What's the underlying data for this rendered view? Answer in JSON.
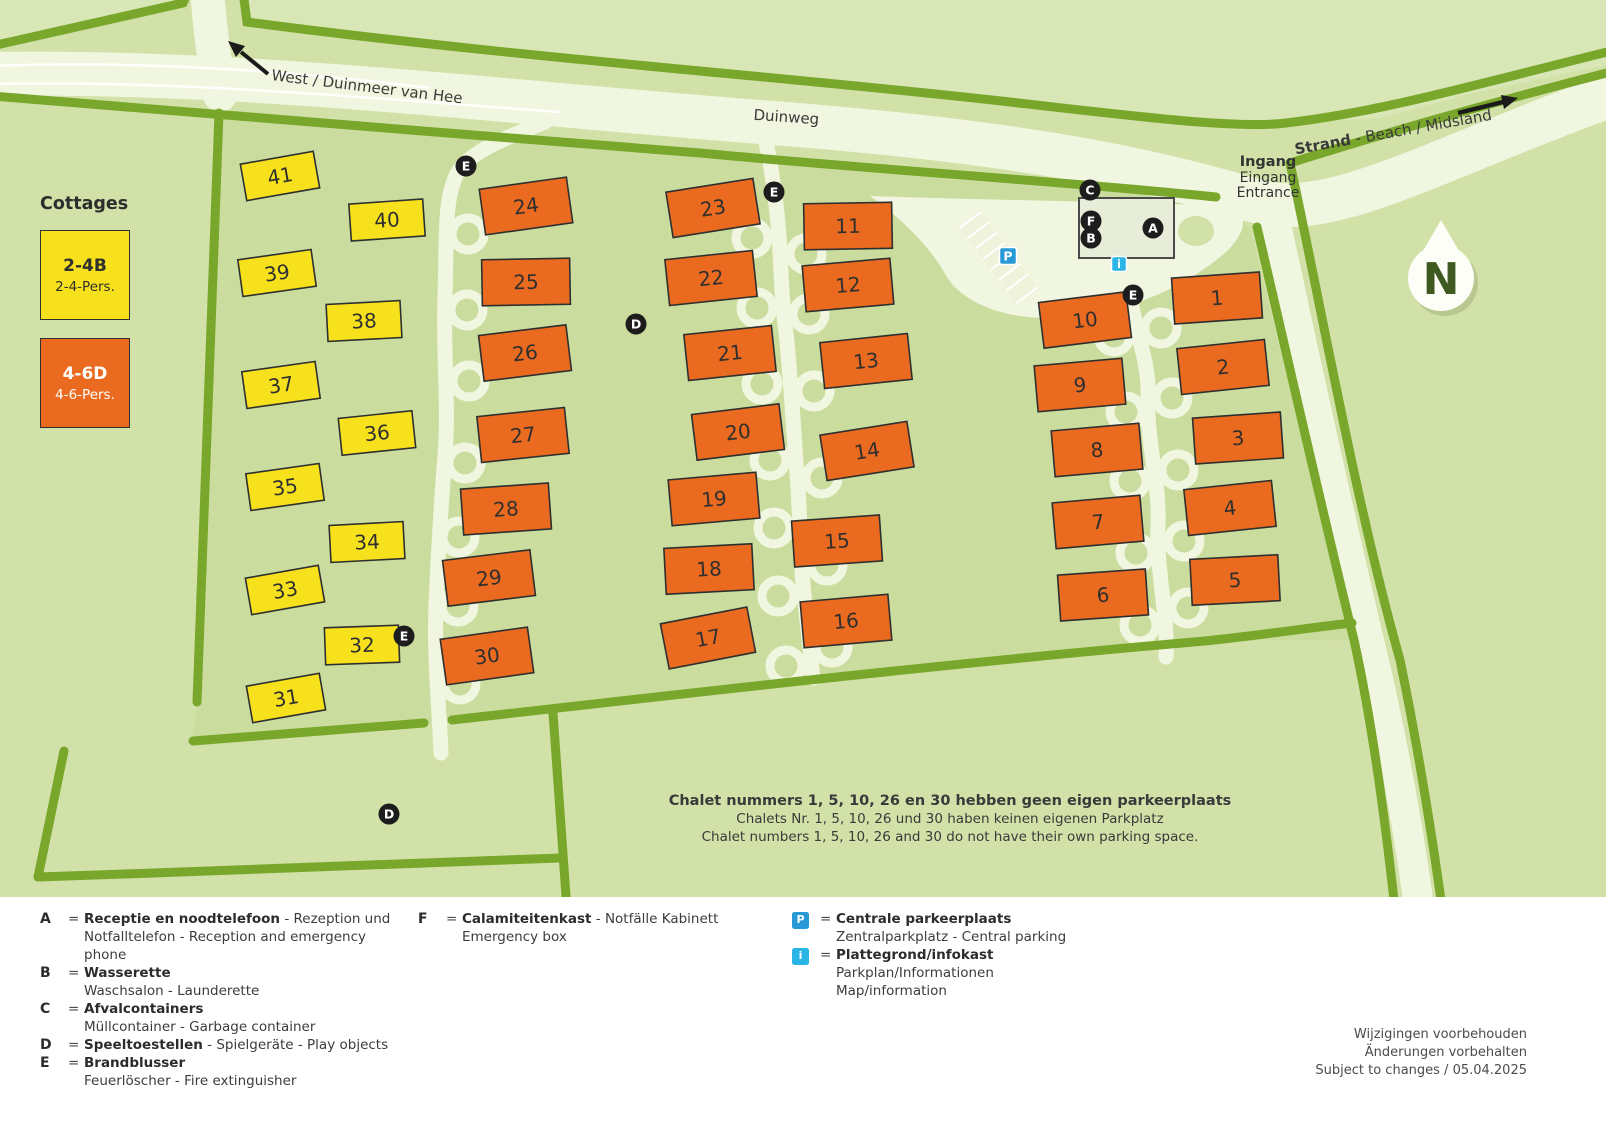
{
  "map": {
    "labels": {
      "west": "West / Duinmeer van Hee",
      "duinweg": "Duinweg",
      "strand_bold": "Strand",
      "strand_rest": " - Beach / Midsland",
      "ingang": [
        "Ingang",
        "Eingang",
        "Entrance"
      ],
      "compass": "N"
    },
    "chalets": [
      {
        "n": "41",
        "x": 280,
        "y": 176,
        "r": -10,
        "t": "y"
      },
      {
        "n": "40",
        "x": 387,
        "y": 220,
        "r": -4,
        "t": "y"
      },
      {
        "n": "39",
        "x": 277,
        "y": 273,
        "r": -8,
        "t": "y"
      },
      {
        "n": "38",
        "x": 364,
        "y": 321,
        "r": -3,
        "t": "y"
      },
      {
        "n": "37",
        "x": 281,
        "y": 385,
        "r": -8,
        "t": "y"
      },
      {
        "n": "36",
        "x": 377,
        "y": 433,
        "r": -6,
        "t": "y"
      },
      {
        "n": "35",
        "x": 285,
        "y": 487,
        "r": -8,
        "t": "y"
      },
      {
        "n": "34",
        "x": 367,
        "y": 542,
        "r": -3,
        "t": "y"
      },
      {
        "n": "33",
        "x": 285,
        "y": 590,
        "r": -10,
        "t": "y"
      },
      {
        "n": "32",
        "x": 362,
        "y": 645,
        "r": -2,
        "t": "y"
      },
      {
        "n": "31",
        "x": 286,
        "y": 698,
        "r": -10,
        "t": "y"
      },
      {
        "n": "24",
        "x": 526,
        "y": 206,
        "r": -8,
        "t": "o",
        "lx": 468,
        "ly": 234
      },
      {
        "n": "25",
        "x": 526,
        "y": 282,
        "r": -1,
        "t": "o",
        "lx": 467,
        "ly": 310
      },
      {
        "n": "26",
        "x": 525,
        "y": 353,
        "r": -7,
        "t": "o",
        "lx": 469,
        "ly": 381
      },
      {
        "n": "27",
        "x": 523,
        "y": 435,
        "r": -6,
        "t": "o",
        "lx": 465,
        "ly": 463
      },
      {
        "n": "28",
        "x": 506,
        "y": 509,
        "r": -4,
        "t": "o",
        "lx": 459,
        "ly": 537
      },
      {
        "n": "29",
        "x": 489,
        "y": 578,
        "r": -7,
        "t": "o",
        "lx": 458,
        "ly": 606
      },
      {
        "n": "30",
        "x": 487,
        "y": 656,
        "r": -8,
        "t": "o",
        "lx": 460,
        "ly": 684
      },
      {
        "n": "23",
        "x": 713,
        "y": 208,
        "r": -9,
        "t": "o",
        "lx": 752,
        "ly": 238
      },
      {
        "n": "22",
        "x": 711,
        "y": 278,
        "r": -6,
        "t": "o",
        "lx": 757,
        "ly": 308
      },
      {
        "n": "21",
        "x": 730,
        "y": 353,
        "r": -6,
        "t": "o",
        "lx": 762,
        "ly": 384
      },
      {
        "n": "20",
        "x": 738,
        "y": 432,
        "r": -7,
        "t": "o",
        "lx": 770,
        "ly": 460
      },
      {
        "n": "19",
        "x": 714,
        "y": 499,
        "r": -5,
        "t": "o",
        "lx": 774,
        "ly": 528
      },
      {
        "n": "18",
        "x": 709,
        "y": 569,
        "r": -3,
        "t": "o",
        "lx": 778,
        "ly": 596
      },
      {
        "n": "17",
        "x": 708,
        "y": 638,
        "r": -11,
        "t": "o",
        "lx": 786,
        "ly": 666
      },
      {
        "n": "11",
        "x": 848,
        "y": 226,
        "r": -1,
        "t": "o",
        "lx": 806,
        "ly": 254
      },
      {
        "n": "12",
        "x": 848,
        "y": 285,
        "r": -5,
        "t": "o",
        "lx": 809,
        "ly": 314
      },
      {
        "n": "13",
        "x": 866,
        "y": 361,
        "r": -6,
        "t": "o",
        "lx": 814,
        "ly": 391
      },
      {
        "n": "14",
        "x": 867,
        "y": 451,
        "r": -9,
        "t": "o",
        "lx": 822,
        "ly": 478
      },
      {
        "n": "15",
        "x": 837,
        "y": 541,
        "r": -4,
        "t": "o",
        "lx": 827,
        "ly": 565
      },
      {
        "n": "16",
        "x": 846,
        "y": 621,
        "r": -5,
        "t": "o",
        "lx": 832,
        "ly": 647
      },
      {
        "n": "10",
        "x": 1085,
        "y": 320,
        "r": -7,
        "t": "o",
        "lx": 1114,
        "ly": 336
      },
      {
        "n": "9",
        "x": 1080,
        "y": 385,
        "r": -5,
        "t": "o",
        "lx": 1126,
        "ly": 412
      },
      {
        "n": "8",
        "x": 1097,
        "y": 450,
        "r": -5,
        "t": "o",
        "lx": 1130,
        "ly": 481
      },
      {
        "n": "7",
        "x": 1098,
        "y": 522,
        "r": -5,
        "t": "o",
        "lx": 1136,
        "ly": 553
      },
      {
        "n": "6",
        "x": 1103,
        "y": 595,
        "r": -4,
        "t": "o",
        "lx": 1140,
        "ly": 625
      },
      {
        "n": "1",
        "x": 1217,
        "y": 298,
        "r": -4,
        "t": "o",
        "lx": 1161,
        "ly": 328
      },
      {
        "n": "2",
        "x": 1223,
        "y": 367,
        "r": -6,
        "t": "o",
        "lx": 1172,
        "ly": 398
      },
      {
        "n": "3",
        "x": 1238,
        "y": 438,
        "r": -4,
        "t": "o",
        "lx": 1178,
        "ly": 470
      },
      {
        "n": "4",
        "x": 1230,
        "y": 508,
        "r": -6,
        "t": "o",
        "lx": 1184,
        "ly": 541
      },
      {
        "n": "5",
        "x": 1235,
        "y": 580,
        "r": -3,
        "t": "o",
        "lx": 1188,
        "ly": 608
      }
    ],
    "markers": [
      {
        "l": "C",
        "x": 1090,
        "y": 190
      },
      {
        "l": "F",
        "x": 1091,
        "y": 221
      },
      {
        "l": "B",
        "x": 1091,
        "y": 238
      },
      {
        "l": "A",
        "x": 1153,
        "y": 228
      },
      {
        "l": "E",
        "x": 466,
        "y": 166
      },
      {
        "l": "E",
        "x": 774,
        "y": 192
      },
      {
        "l": "E",
        "x": 1133,
        "y": 295
      },
      {
        "l": "E",
        "x": 404,
        "y": 636
      },
      {
        "l": "D",
        "x": 636,
        "y": 324
      },
      {
        "l": "D",
        "x": 389,
        "y": 814
      }
    ],
    "p_marker": {
      "x": 1008,
      "y": 256,
      "label": "P"
    },
    "i_marker": {
      "x": 1119,
      "y": 264,
      "label": "i"
    }
  },
  "cottages": {
    "title": "Cottages",
    "yellow": {
      "code": "2-4B",
      "pers": "2-4-Pers."
    },
    "orange": {
      "code": "4-6D",
      "pers": "4-6-Pers."
    }
  },
  "note": {
    "bold": "Chalet nummers 1, 5, 10, 26 en 30 hebben geen eigen parkeerplaats",
    "de": "Chalets Nr. 1, 5, 10, 26 und 30 haben keinen eigenen Parkplatz",
    "en": "Chalet numbers 1, 5, 10, 26 and 30 do not have their own parking space."
  },
  "legend": {
    "eq": "=",
    "a": {
      "key": "A",
      "bold": "Receptie en noodtelefoon",
      "rest": " - Rezeption und",
      "line2": "Notfalltelefon - Reception and emergency phone"
    },
    "b": {
      "key": "B",
      "bold": "Wasserette",
      "rest": "",
      "line2": "Waschsalon - Launderette"
    },
    "c": {
      "key": "C",
      "bold": "Afvalcontainers",
      "rest": "",
      "line2": "Müllcontainer - Garbage container"
    },
    "d": {
      "key": "D",
      "bold": "Speeltoestellen",
      "rest": " - Spielgeräte - Play objects"
    },
    "e": {
      "key": "E",
      "bold": "Brandblusser",
      "rest": "",
      "line2": "Feuerlöscher - Fire extinguisher"
    },
    "f": {
      "key": "F",
      "bold": "Calamiteitenkast",
      "rest": " - Notfälle Kabinett",
      "line2": "Emergency box"
    },
    "p": {
      "icon": "P",
      "bold": "Centrale parkeerplaats",
      "line2": "Zentralparkplatz - Central parking"
    },
    "i": {
      "icon": "i",
      "bold": "Plattegrond/infokast",
      "line2": "Parkplan/Informationen",
      "line3": "Map/information"
    }
  },
  "disclaimer": [
    "Wijzigingen voorbehouden",
    "Änderungen vorbehalten",
    "Subject to changes / 05.04.2025"
  ],
  "colors": {
    "background": "#d2e1a8",
    "park_interior": "#cbdd9e",
    "road": "#f1f6e0",
    "hedge": "#79a72c",
    "chalet_orange": "#ea6b1f",
    "cottage_yellow": "#f6e11c",
    "marker_black": "#1d1d1d",
    "parking_blue": "#2699d6",
    "info_cyan": "#29b5e5"
  }
}
